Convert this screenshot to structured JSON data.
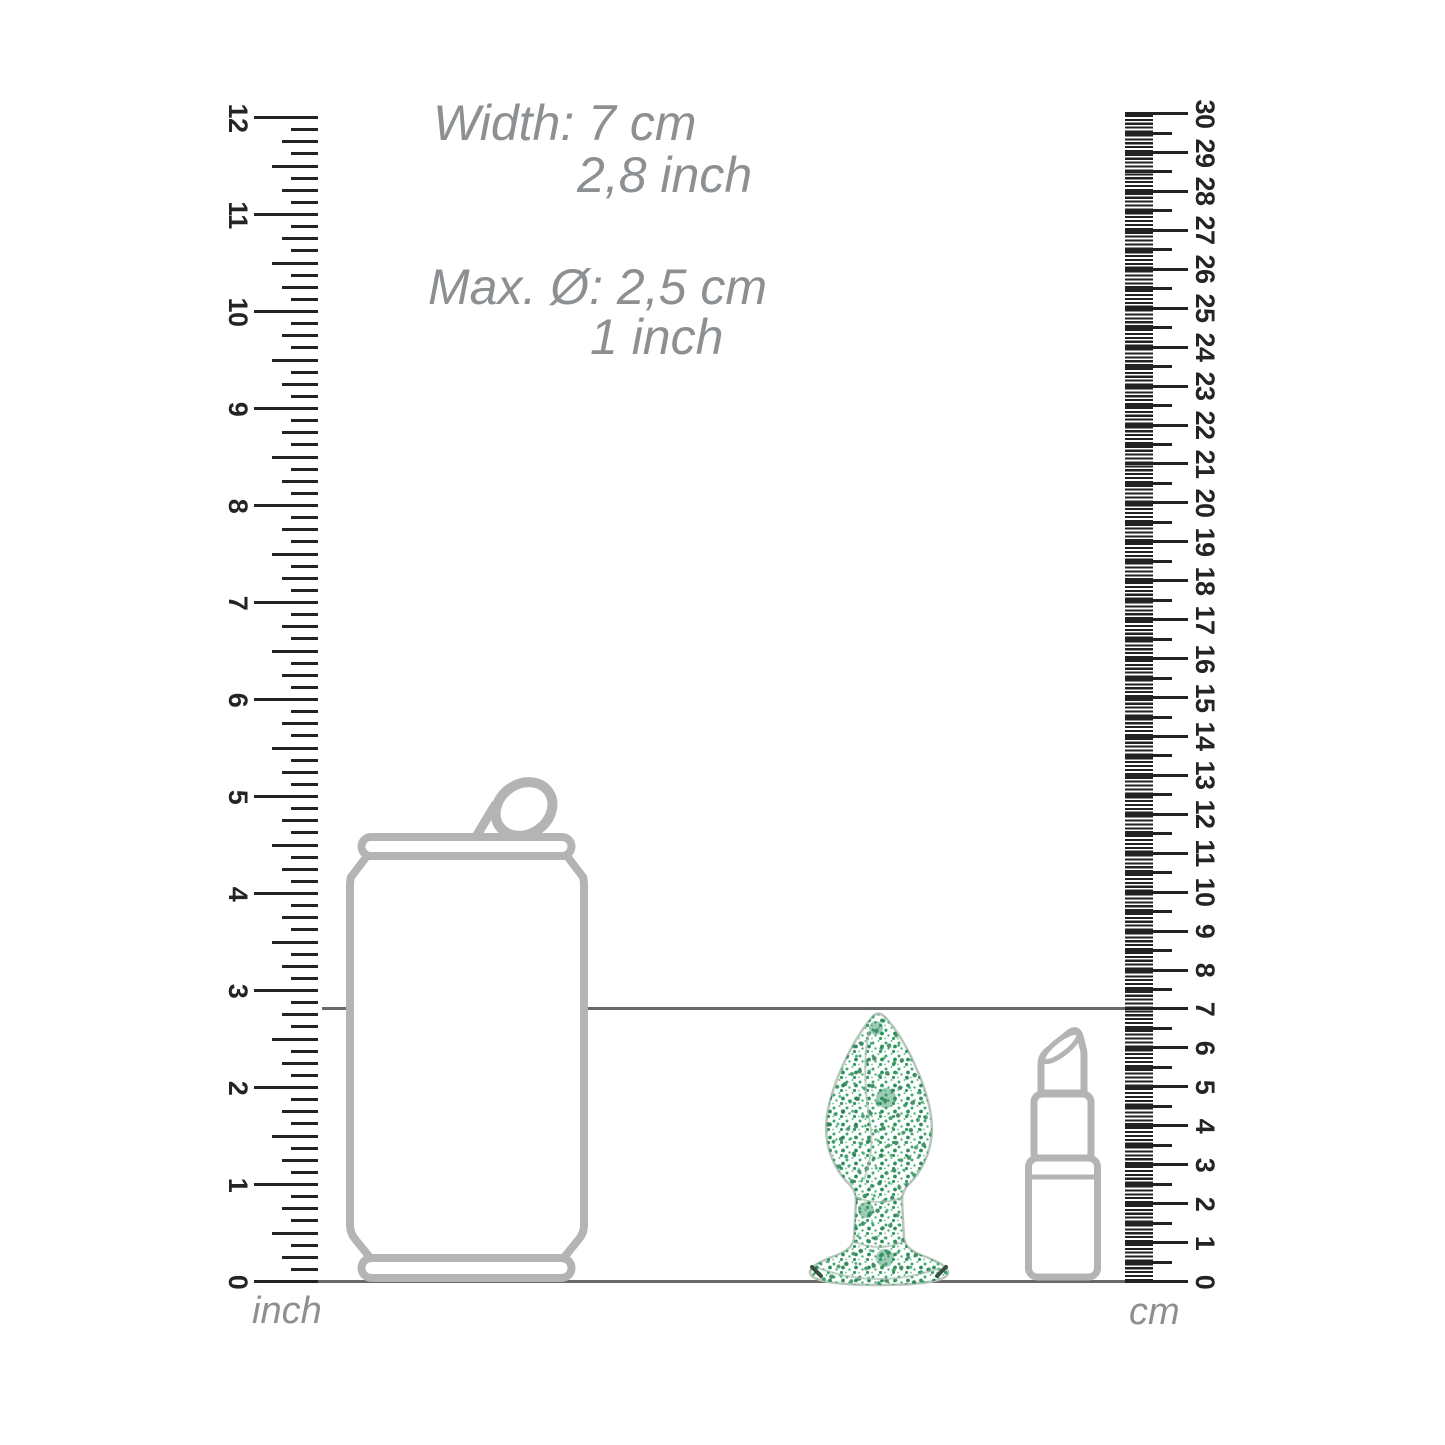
{
  "title": {
    "width_metric": "Width: 7 cm",
    "width_imperial": "2,8 inch",
    "diameter_metric": "Max. Ø: 2,5 cm",
    "diameter_imperial": "1 inch"
  },
  "rulers": {
    "inch": {
      "unit": "inch",
      "min": 0,
      "max": 12,
      "subdivisions_per_unit": 8,
      "labels": [
        "0",
        "1",
        "2",
        "3",
        "4",
        "5",
        "6",
        "7",
        "8",
        "9",
        "10",
        "11",
        "12"
      ]
    },
    "cm": {
      "unit": "cm",
      "min": 0,
      "max": 30,
      "subdivisions_per_unit": 10,
      "labels": [
        "0",
        "1",
        "2",
        "3",
        "4",
        "5",
        "6",
        "7",
        "8",
        "9",
        "10",
        "11",
        "12",
        "13",
        "14",
        "15",
        "16",
        "17",
        "18",
        "19",
        "20",
        "21",
        "22",
        "23",
        "24",
        "25",
        "26",
        "27",
        "28",
        "29",
        "30"
      ]
    }
  },
  "markers": {
    "product_height": {
      "cm": 7,
      "inch": 2.8
    },
    "baseline": {
      "cm": 0,
      "inch": 0
    }
  },
  "reference_objects": [
    "soda-can",
    "glitter-plug",
    "lipstick"
  ],
  "colors": {
    "background": "#ffffff",
    "tick_black": "#222222",
    "ruler_number": "#242424",
    "caption_gray": "#8d9093",
    "outline_gray": "#b4b4b4",
    "marker_line_gray": "#686868",
    "glitter_green": "#3aa56b",
    "glitter_green_dark": "#2e8f5c",
    "glass_edge": "#b9c6bc"
  }
}
